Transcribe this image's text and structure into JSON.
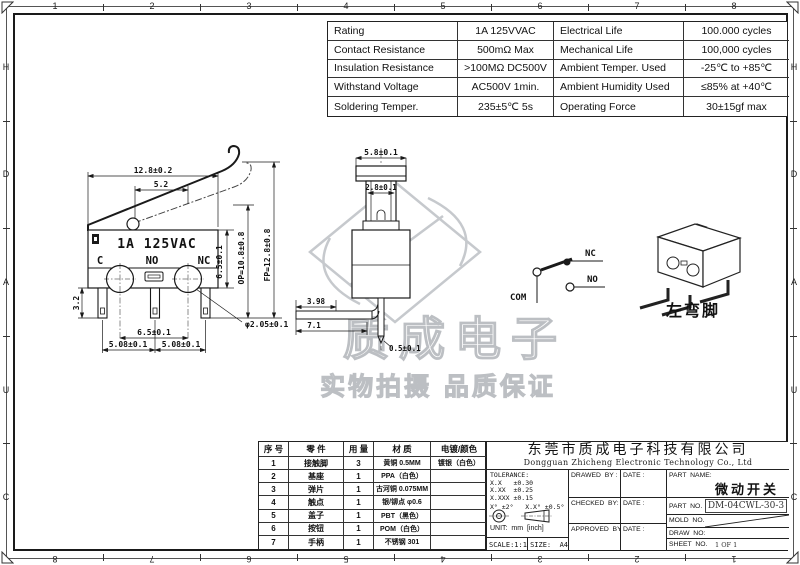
{
  "frame": {
    "top_numbers": [
      "1",
      "2",
      "3",
      "4",
      "5",
      "6",
      "7",
      "8"
    ],
    "bottom_numbers": [
      "8",
      "7",
      "6",
      "5",
      "4",
      "3",
      "2",
      "1"
    ],
    "left_letters": [
      "H",
      "D",
      "A",
      "U",
      "C"
    ],
    "right_letters": [
      "H",
      "D",
      "A",
      "U",
      "C"
    ]
  },
  "spec_table": {
    "rows": [
      [
        "Rating",
        "1A  125VVAC",
        "Electrical Life",
        "100.000 cycles"
      ],
      [
        "Contact Resistance",
        "500mΩ  Max",
        "Mechanical Life",
        "100,000 cycles"
      ],
      [
        "Insulation Resistance",
        ">100MΩ DC500V",
        "Ambient Temper. Used",
        "-25℃ to +85℃"
      ],
      [
        "Withstand Voltage",
        "AC500V  1min.",
        "Ambient Humidity Used",
        "≤85% at +40℃"
      ],
      [
        "Soldering Temper.",
        "235±5℃ 5s",
        "Operating Force",
        "30±15gf max"
      ]
    ]
  },
  "drawings": {
    "front": {
      "rating": "1A 125VAC",
      "terminal_c": "C",
      "terminal_no": "NO",
      "terminal_nc": "NC",
      "dim_width": "12.8±0.2",
      "dim_lever": "5.2",
      "dim_pin_len": "3.2",
      "dim_body_h": "6.5±0.1",
      "dim_op": "OP=10.8±0.8",
      "dim_fp": "FP=12.8±0.8",
      "dim_span": "6.5±0.1",
      "dim_pitch_l": "5.08±0.1",
      "dim_pitch_r": "5.08±0.1",
      "dim_hole": "φ2.05±0.1"
    },
    "side": {
      "dim_width": "5.8±0.1",
      "dim_button": "2.8±0.1",
      "dim_a": "3.98",
      "dim_b": "7.1",
      "dim_tip": "0.5±0.1"
    },
    "circuit": {
      "nc": "NC",
      "no": "NO",
      "com": "COM"
    },
    "iso": {
      "caption": "左弯脚"
    }
  },
  "watermark": {
    "brand": "质成电子",
    "slogan": "实物拍摄 品质保证"
  },
  "bom": {
    "headers": [
      "序 号",
      "零 件",
      "用 量",
      "材 质",
      "电镀/颜色"
    ],
    "rows": [
      [
        "1",
        "接触脚",
        "3",
        "黄铜 0.5MM",
        "镀银（白色）"
      ],
      [
        "2",
        "基座",
        "1",
        "PPA（白色）",
        ""
      ],
      [
        "3",
        "弹片",
        "1",
        "古河铜 0.075MM",
        ""
      ],
      [
        "4",
        "触点",
        "1",
        "银/铆点 φ0.6",
        ""
      ],
      [
        "5",
        "盖子",
        "1",
        "PBT（黑色）",
        ""
      ],
      [
        "6",
        "按钮",
        "1",
        "POM（白色）",
        ""
      ],
      [
        "7",
        "手柄",
        "1",
        "不锈钢 301",
        ""
      ]
    ]
  },
  "title_block": {
    "company_cn": "东莞市质成电子科技有限公司",
    "company_en": "Dongguan Zhicheng Electronic Technology Co., Ltd",
    "tolerance_title": "TOLERANCE:",
    "tol1": "X.X   ±0.30",
    "tol2": "X.XX  ±0.25",
    "tol3": "X.XXX ±0.15",
    "tol_angle": "X° ±2°   X.X° ±0.5°",
    "unit": "UNIT:  mm  [inch]",
    "scale": "SCALE:1:1",
    "size": "SIZE:  A4",
    "drawed_by": "DRAWED  BY :",
    "date1": "DATE :",
    "checked_by": "CHECKED  BY:",
    "date2": "DATE :",
    "approved_by": "APPROVED  BY:",
    "date3": "DATE :",
    "part_name_label": "PART  NAME:",
    "part_name": "微动开关",
    "part_no_label": "PART  NO.",
    "part_no": "DM-04CWL-30-3",
    "mold_no_label": "MOLD  NO.",
    "draw_no_label": "DRAW  NO:",
    "sheet_no_label": "SHEET  NO.",
    "sheet_no": "1 OF 1"
  }
}
